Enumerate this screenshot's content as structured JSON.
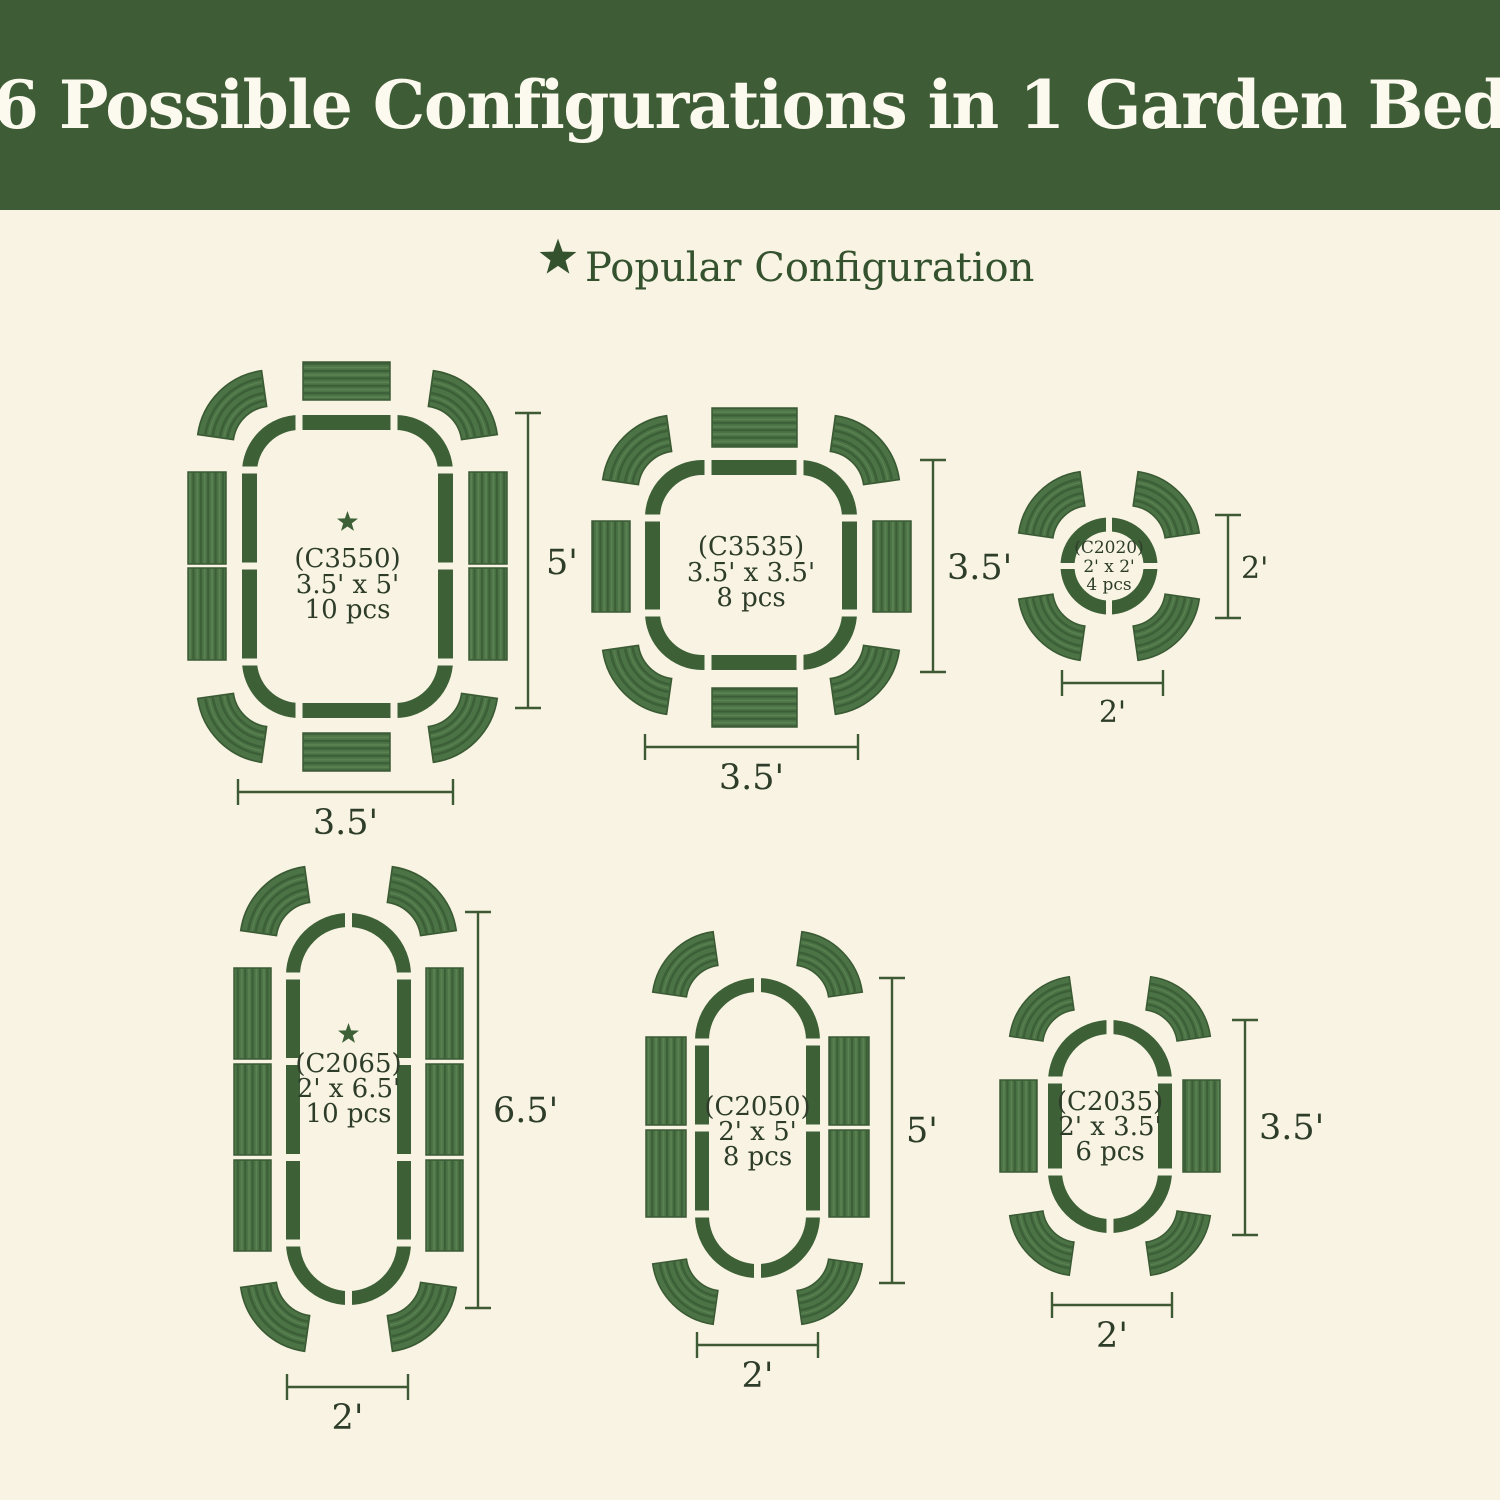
{
  "header": {
    "title": "6 Possible Configurations in 1 Garden Bed"
  },
  "legend": {
    "star_icon": "star",
    "label": "Popular Configuration"
  },
  "palette": {
    "background": "#f8f3e2",
    "banner_green": "#3e5c36",
    "banner_text": "#fcf9ee",
    "panel_green": "#4b7345",
    "panel_ridge_dark": "#3c5f38",
    "panel_ridge_light": "#5b8252",
    "outline_green": "#3d6037",
    "label_text_green": "#2e3d2a",
    "legend_green": "#35522f"
  },
  "configurations": [
    {
      "id": "C3550",
      "code": "(C3550)",
      "size": "3.5' x 5'",
      "pieces": "10 pcs",
      "popular": true,
      "width_label": "3.5'",
      "height_label": "5'"
    },
    {
      "id": "C3535",
      "code": "(C3535)",
      "size": "3.5' x 3.5'",
      "pieces": "8 pcs",
      "popular": false,
      "width_label": "3.5'",
      "height_label": "3.5'"
    },
    {
      "id": "C2020",
      "code": "(C2020)",
      "size": "2' x 2'",
      "pieces": "4 pcs",
      "popular": false,
      "width_label": "2'",
      "height_label": "2'"
    },
    {
      "id": "C2065",
      "code": "(C2065)",
      "size": "2' x 6.5'",
      "pieces": "10 pcs",
      "popular": true,
      "width_label": "2'",
      "height_label": "6.5'"
    },
    {
      "id": "C2050",
      "code": "(C2050)",
      "size": "2' x 5'",
      "pieces": "8 pcs",
      "popular": false,
      "width_label": "2'",
      "height_label": "5'"
    },
    {
      "id": "C2035",
      "code": "(C2035)",
      "size": "2' x 3.5'",
      "pieces": "6 pcs",
      "popular": false,
      "width_label": "2'",
      "height_label": "3.5'"
    }
  ]
}
